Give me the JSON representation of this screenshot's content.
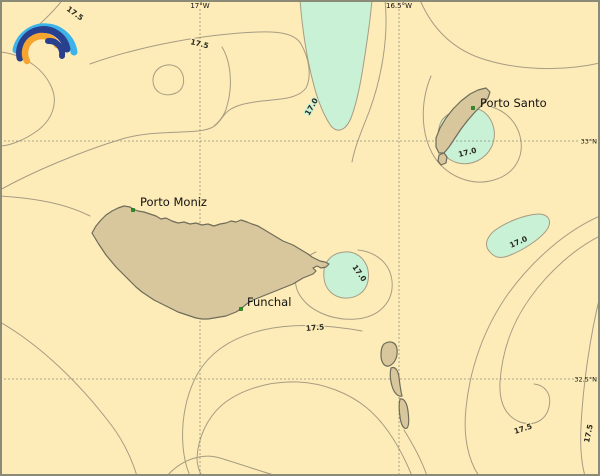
{
  "colors": {
    "sea": "#fdecb8",
    "land": "#d8c69d",
    "land_outline": "#6f6c59",
    "contour_line": "#a79c83",
    "cool_region": "#c9f1d6",
    "graticule": "#90907e",
    "frame_border": "#8a8a76",
    "place_marker": "#1f9a1f",
    "logo_light_blue": "#3cb4ea",
    "logo_navy": "#28408e",
    "logo_orange": "#f7a52f"
  },
  "graticule": {
    "meridians": [
      {
        "label": "17°W"
      },
      {
        "label": "16.5°W"
      }
    ],
    "parallels": [
      {
        "label": "33°N"
      },
      {
        "label": "32.5°N"
      }
    ]
  },
  "places": [
    {
      "label": "Porto Moniz"
    },
    {
      "label": "Funchal"
    },
    {
      "label": "Porto Santo"
    }
  ],
  "contour_labels": [
    {
      "text": "17.5"
    },
    {
      "text": "17.5"
    },
    {
      "text": "17.0"
    },
    {
      "text": "17.0"
    },
    {
      "text": "17.0"
    },
    {
      "text": "17.0"
    },
    {
      "text": "17.5"
    },
    {
      "text": "17.5"
    },
    {
      "text": "17.5"
    }
  ],
  "logo": {
    "name": "rainbow-arcs-logo"
  }
}
